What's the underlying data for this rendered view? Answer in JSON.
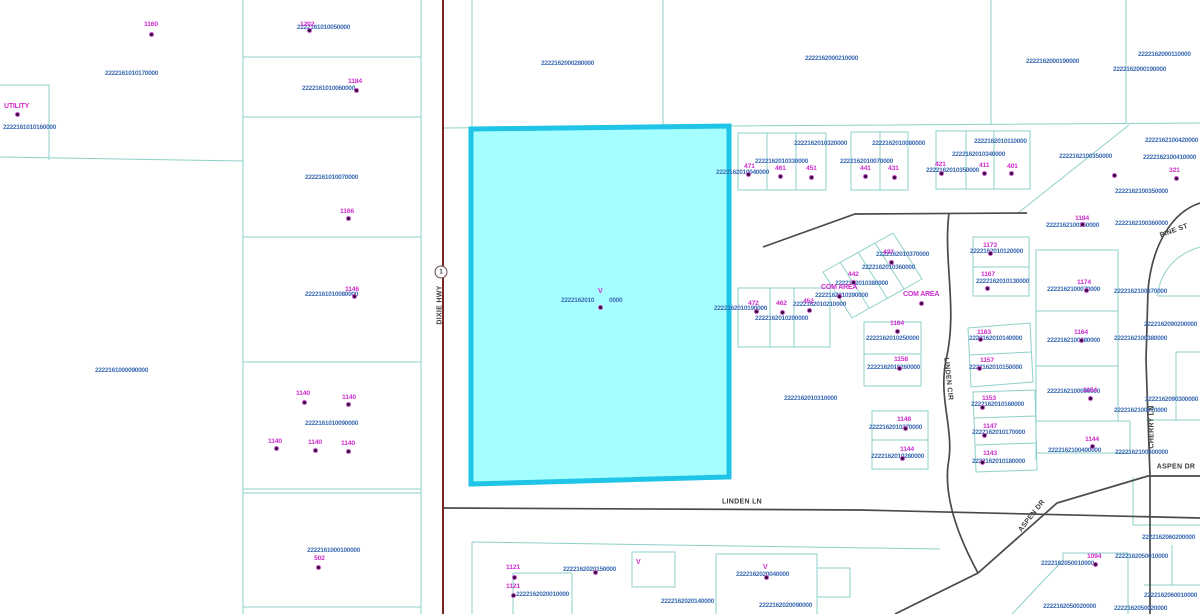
{
  "map": {
    "colors": {
      "parcel_line": "#8ed1c9",
      "road_line": "#4a4a4a",
      "highway_line": "#7a2424",
      "parcel_id_text": "#3b6cb4",
      "house_number_text": "#cf2ecf",
      "highlight_fill": "#a5feff",
      "highlight_stroke": "#1fc4e6"
    },
    "route_shield": {
      "label": "1",
      "x": 441,
      "y": 272
    },
    "highlight_parcel": {
      "id_left": "2222162010",
      "id_right": "0000",
      "marker": "V"
    },
    "streets": [
      {
        "t": "DIXIE HWY",
        "x": 440,
        "y": 305,
        "r": -90
      },
      {
        "t": "LINDEN LN",
        "x": 742,
        "y": 502,
        "r": 0
      },
      {
        "t": "LINDEN CIR",
        "x": 948,
        "y": 379,
        "r": 84
      },
      {
        "t": "CHERRY LN",
        "x": 1152,
        "y": 427,
        "r": -90
      },
      {
        "t": "PINE ST",
        "x": 1174,
        "y": 231,
        "r": -20
      },
      {
        "t": "ASPEN DR",
        "x": 1032,
        "y": 516,
        "r": -52
      },
      {
        "t": "ASPEN DR",
        "x": 1176,
        "y": 467,
        "r": 0
      }
    ],
    "area_labels": [
      {
        "t": "UTILITY",
        "x": 4,
        "y": 103
      },
      {
        "t": "COM AREA",
        "x": 821,
        "y": 284
      },
      {
        "t": "COM AREA",
        "x": 903,
        "y": 291
      }
    ],
    "v_markers": [
      {
        "x": 598,
        "y": 288
      },
      {
        "x": 636,
        "y": 559
      },
      {
        "x": 763,
        "y": 564
      }
    ],
    "parcel_labels": [
      {
        "t": "2222161010170000",
        "x": 105,
        "y": 71
      },
      {
        "t": "2222161010050000",
        "x": 297,
        "y": 25
      },
      {
        "t": "2222161010060000",
        "x": 302,
        "y": 86
      },
      {
        "t": "2222161010070000",
        "x": 305,
        "y": 175
      },
      {
        "t": "2222161010160000",
        "x": 3,
        "y": 125
      },
      {
        "t": "2222161010080000",
        "x": 305,
        "y": 292
      },
      {
        "t": "2222161000090000",
        "x": 95,
        "y": 368
      },
      {
        "t": "2222161010090000",
        "x": 305,
        "y": 421
      },
      {
        "t": "2222161000100000",
        "x": 307,
        "y": 548
      },
      {
        "t": "2222162000280000",
        "x": 541,
        "y": 61
      },
      {
        "t": "2222162000210000",
        "x": 805,
        "y": 56
      },
      {
        "t": "2222162000190000",
        "x": 1026,
        "y": 59
      },
      {
        "t": "2222162000190000",
        "x": 1113,
        "y": 67
      },
      {
        "t": "2222162000110000",
        "x": 1138,
        "y": 52
      },
      {
        "t": "2222162010",
        "x": 561,
        "y": 298
      },
      {
        "t": "0000",
        "x": 609,
        "y": 298
      },
      {
        "t": "2222162010320000",
        "x": 794,
        "y": 141
      },
      {
        "t": "2222162010330000",
        "x": 755,
        "y": 159
      },
      {
        "t": "2222162010040000",
        "x": 716,
        "y": 170
      },
      {
        "t": "2222162010080000",
        "x": 872,
        "y": 141
      },
      {
        "t": "2222162010070000",
        "x": 840,
        "y": 159
      },
      {
        "t": "2222162010110000",
        "x": 974,
        "y": 139
      },
      {
        "t": "2222162010340000",
        "x": 952,
        "y": 152
      },
      {
        "t": "2222162010350000",
        "x": 926,
        "y": 168
      },
      {
        "t": "2222162100420000",
        "x": 1145,
        "y": 138
      },
      {
        "t": "2222162100350000",
        "x": 1059,
        "y": 154
      },
      {
        "t": "2222162100410000",
        "x": 1143,
        "y": 155
      },
      {
        "t": "2222162100350000",
        "x": 1115,
        "y": 189
      },
      {
        "t": "2222162100360000",
        "x": 1046,
        "y": 223
      },
      {
        "t": "2222162100360000",
        "x": 1115,
        "y": 221
      },
      {
        "t": "2222162010370000",
        "x": 876,
        "y": 252
      },
      {
        "t": "2222162010360000",
        "x": 862,
        "y": 265
      },
      {
        "t": "2222162010380000",
        "x": 835,
        "y": 281
      },
      {
        "t": "2222162010390000",
        "x": 815,
        "y": 293
      },
      {
        "t": "2222162010120000",
        "x": 970,
        "y": 249
      },
      {
        "t": "2222162010130000",
        "x": 976,
        "y": 279
      },
      {
        "t": "2222162100070000",
        "x": 1047,
        "y": 287
      },
      {
        "t": "2222162100370000",
        "x": 1114,
        "y": 289
      },
      {
        "t": "2222162090200000",
        "x": 1144,
        "y": 322
      },
      {
        "t": "2222162100080000",
        "x": 1047,
        "y": 338
      },
      {
        "t": "2222162100380000",
        "x": 1114,
        "y": 336
      },
      {
        "t": "2222162100090000",
        "x": 1047,
        "y": 389
      },
      {
        "t": "2222162090300000",
        "x": 1145,
        "y": 397
      },
      {
        "t": "2222162100070000",
        "x": 1114,
        "y": 408
      },
      {
        "t": "2222162010190000",
        "x": 714,
        "y": 306
      },
      {
        "t": "2222162010210000",
        "x": 793,
        "y": 302
      },
      {
        "t": "2222162010200000",
        "x": 755,
        "y": 316
      },
      {
        "t": "2222162010310000",
        "x": 784,
        "y": 396
      },
      {
        "t": "2222162010250000",
        "x": 866,
        "y": 336
      },
      {
        "t": "2222162010260000",
        "x": 867,
        "y": 365
      },
      {
        "t": "2222162010270000",
        "x": 869,
        "y": 425
      },
      {
        "t": "2222162010280000",
        "x": 871,
        "y": 454
      },
      {
        "t": "2222162010140000",
        "x": 969,
        "y": 336
      },
      {
        "t": "2222162010150000",
        "x": 969,
        "y": 365
      },
      {
        "t": "2222162010160000",
        "x": 971,
        "y": 402
      },
      {
        "t": "2222162010170000",
        "x": 972,
        "y": 430
      },
      {
        "t": "2222162010180000",
        "x": 972,
        "y": 459
      },
      {
        "t": "2222162100400000",
        "x": 1048,
        "y": 448
      },
      {
        "t": "2222162100400000",
        "x": 1115,
        "y": 450
      },
      {
        "t": "2222162060200000",
        "x": 1142,
        "y": 535
      },
      {
        "t": "2222162050010000",
        "x": 1041,
        "y": 561
      },
      {
        "t": "2222162050010000",
        "x": 1115,
        "y": 554
      },
      {
        "t": "2222162060010000",
        "x": 1144,
        "y": 593
      },
      {
        "t": "2222162050020000",
        "x": 1043,
        "y": 604
      },
      {
        "t": "2222162050020000",
        "x": 1114,
        "y": 606
      },
      {
        "t": "2222162020010000",
        "x": 516,
        "y": 592
      },
      {
        "t": "2222162020150000",
        "x": 563,
        "y": 567
      },
      {
        "t": "2222162020140000",
        "x": 661,
        "y": 599
      },
      {
        "t": "2222162020040000",
        "x": 736,
        "y": 572
      },
      {
        "t": "2222162020090000",
        "x": 759,
        "y": 603
      }
    ],
    "house_numbers": [
      {
        "t": "1160",
        "x": 144,
        "y": 22
      },
      {
        "t": "1202",
        "x": 300,
        "y": 22
      },
      {
        "t": "1184",
        "x": 348,
        "y": 79
      },
      {
        "t": "1166",
        "x": 340,
        "y": 209
      },
      {
        "t": "1146",
        "x": 345,
        "y": 287
      },
      {
        "t": "1140",
        "x": 296,
        "y": 391
      },
      {
        "t": "1140",
        "x": 342,
        "y": 395
      },
      {
        "t": "1140",
        "x": 268,
        "y": 439
      },
      {
        "t": "1140",
        "x": 308,
        "y": 440
      },
      {
        "t": "1140",
        "x": 341,
        "y": 441
      },
      {
        "t": "502",
        "x": 314,
        "y": 556
      },
      {
        "t": "1121",
        "x": 506,
        "y": 565
      },
      {
        "t": "1121",
        "x": 506,
        "y": 584
      },
      {
        "t": "471",
        "x": 744,
        "y": 164
      },
      {
        "t": "461",
        "x": 775,
        "y": 166
      },
      {
        "t": "451",
        "x": 806,
        "y": 166
      },
      {
        "t": "441",
        "x": 860,
        "y": 166
      },
      {
        "t": "431",
        "x": 888,
        "y": 166
      },
      {
        "t": "421",
        "x": 935,
        "y": 162
      },
      {
        "t": "411",
        "x": 979,
        "y": 163
      },
      {
        "t": "401",
        "x": 1007,
        "y": 164
      },
      {
        "t": "437",
        "x": 883,
        "y": 250
      },
      {
        "t": "442",
        "x": 848,
        "y": 272
      },
      {
        "t": "452",
        "x": 803,
        "y": 299
      },
      {
        "t": "462",
        "x": 776,
        "y": 301
      },
      {
        "t": "472",
        "x": 748,
        "y": 301
      },
      {
        "t": "321",
        "x": 1169,
        "y": 168
      },
      {
        "t": "1184",
        "x": 1075,
        "y": 216
      },
      {
        "t": "1173",
        "x": 983,
        "y": 243
      },
      {
        "t": "1167",
        "x": 981,
        "y": 272
      },
      {
        "t": "1174",
        "x": 1077,
        "y": 280
      },
      {
        "t": "1164",
        "x": 1074,
        "y": 330
      },
      {
        "t": "1154",
        "x": 1083,
        "y": 388
      },
      {
        "t": "1163",
        "x": 977,
        "y": 330
      },
      {
        "t": "1157",
        "x": 980,
        "y": 358
      },
      {
        "t": "1153",
        "x": 982,
        "y": 396
      },
      {
        "t": "1147",
        "x": 983,
        "y": 424
      },
      {
        "t": "1143",
        "x": 983,
        "y": 451
      },
      {
        "t": "1164",
        "x": 890,
        "y": 321
      },
      {
        "t": "1158",
        "x": 894,
        "y": 357
      },
      {
        "t": "1148",
        "x": 897,
        "y": 417
      },
      {
        "t": "1144",
        "x": 900,
        "y": 447
      },
      {
        "t": "1144",
        "x": 1085,
        "y": 437
      },
      {
        "t": "1094",
        "x": 1087,
        "y": 554
      }
    ],
    "dots": [
      [
        150,
        33
      ],
      [
        308,
        29
      ],
      [
        355,
        89
      ],
      [
        16,
        113
      ],
      [
        347,
        217
      ],
      [
        353,
        295
      ],
      [
        303,
        401
      ],
      [
        347,
        403
      ],
      [
        275,
        447
      ],
      [
        314,
        449
      ],
      [
        347,
        450
      ],
      [
        317,
        566
      ],
      [
        513,
        576
      ],
      [
        512,
        594
      ],
      [
        594,
        571
      ],
      [
        765,
        576
      ],
      [
        599,
        306
      ],
      [
        747,
        173
      ],
      [
        779,
        175
      ],
      [
        810,
        176
      ],
      [
        864,
        175
      ],
      [
        893,
        176
      ],
      [
        940,
        172
      ],
      [
        983,
        172
      ],
      [
        1010,
        172
      ],
      [
        755,
        310
      ],
      [
        781,
        311
      ],
      [
        808,
        309
      ],
      [
        890,
        261
      ],
      [
        852,
        281
      ],
      [
        838,
        295
      ],
      [
        920,
        302
      ],
      [
        1175,
        177
      ],
      [
        1113,
        174
      ],
      [
        1081,
        223
      ],
      [
        989,
        252
      ],
      [
        986,
        287
      ],
      [
        1085,
        289
      ],
      [
        1080,
        339
      ],
      [
        1089,
        397
      ],
      [
        896,
        330
      ],
      [
        898,
        367
      ],
      [
        904,
        427
      ],
      [
        901,
        457
      ],
      [
        979,
        338
      ],
      [
        978,
        367
      ],
      [
        981,
        406
      ],
      [
        983,
        434
      ],
      [
        981,
        461
      ],
      [
        1091,
        445
      ],
      [
        1094,
        563
      ]
    ]
  }
}
